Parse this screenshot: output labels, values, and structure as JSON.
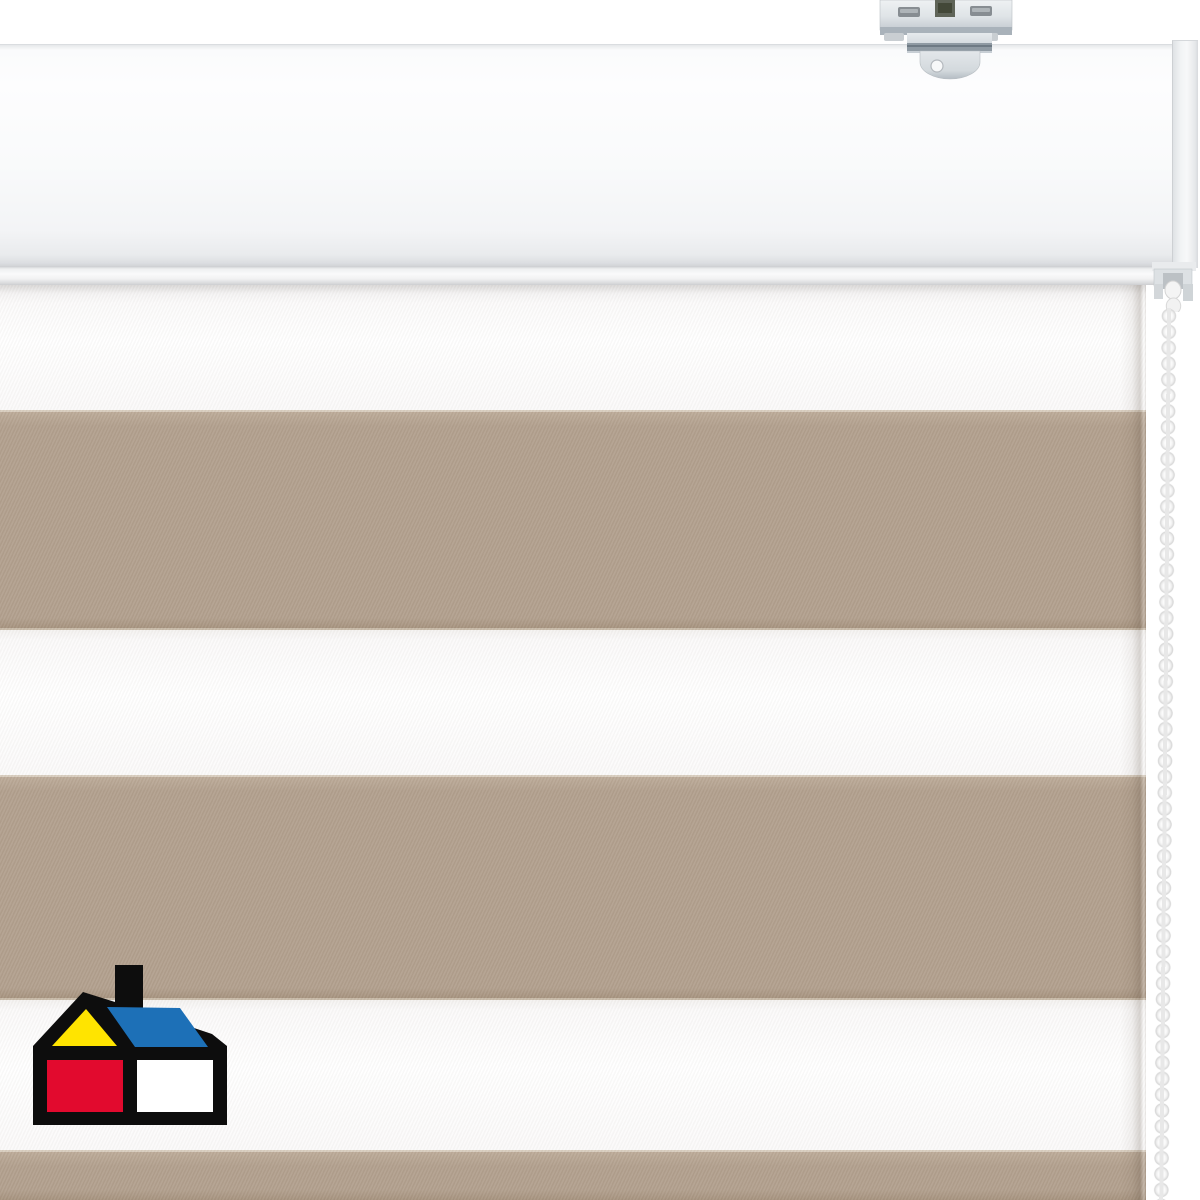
{
  "scene": {
    "subject": "roller-blind-product-photo",
    "parts": {
      "headrail": "white aluminium headrail",
      "bracket": "metal ceiling mounting bracket",
      "chain_mechanism": "chain drive housing",
      "chain": "white bead pull chain",
      "fabric": "day-night zebra blind fabric",
      "logo": "hardware-store-house-logo"
    }
  },
  "colors": {
    "bg": "#ffffff",
    "fabric-white": "#fbfafa",
    "beige": "#b2a08e",
    "beige-light": "#bcab99",
    "beige-dark": "#a6937f",
    "bead-hi": "#fafafa",
    "bead-lo": "#d6d6d6",
    "bead-cord": "#e8e8e8"
  },
  "stripes": {
    "pattern": [
      {
        "id": "white-1",
        "color": "#fbfafa"
      },
      {
        "id": "beige-1",
        "color": "#b2a08e"
      },
      {
        "id": "white-2",
        "color": "#fbfafa"
      },
      {
        "id": "beige-2",
        "color": "#b2a08e"
      },
      {
        "id": "white-3",
        "color": "#fbfafa"
      },
      {
        "id": "beige-3",
        "color": "#b2a08e"
      }
    ]
  },
  "logo": {
    "name": "hardware-store-house-logo",
    "colors": {
      "outline": "#0d0d0d",
      "yellow": "#ffe400",
      "blue": "#1d70b7",
      "red": "#e20a2e",
      "white": "#ffffff"
    }
  },
  "bracket": {
    "metal_light": "#eef1f3",
    "metal_mid": "#cfd4d8",
    "metal_dark": "#9aa2a9",
    "slot_dark": "#5f6458"
  }
}
